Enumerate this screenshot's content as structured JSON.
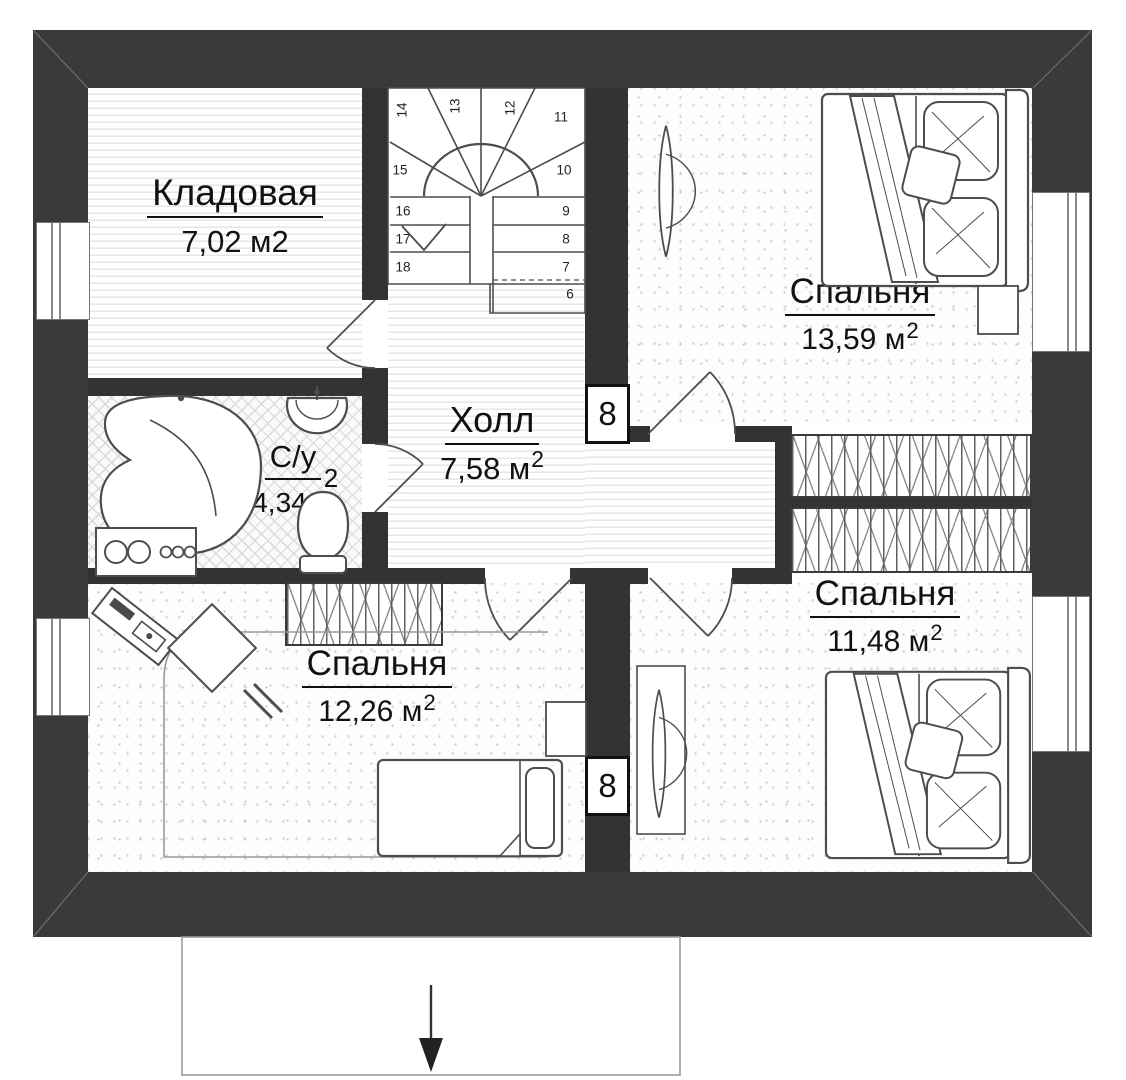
{
  "plan": {
    "rooms": [
      {
        "id": "storage",
        "name": "Кладовая",
        "area": "7,02 м2",
        "area_sup": ""
      },
      {
        "id": "hall",
        "name": "Холл",
        "area": "7,58 м",
        "area_sup": "2"
      },
      {
        "id": "bathroom",
        "name": "С/у",
        "area": "4,34 м",
        "area_sup": "2"
      },
      {
        "id": "bedroom-top-right",
        "name": "Спальня",
        "area": "13,59 м",
        "area_sup": "2"
      },
      {
        "id": "bedroom-bottom-right",
        "name": "Спальня",
        "area": "11,48 м",
        "area_sup": "2"
      },
      {
        "id": "bedroom-bottom-left",
        "name": "Спальня",
        "area": "12,26 м",
        "area_sup": "2"
      }
    ],
    "stairs": {
      "steps": [
        "6",
        "7",
        "8",
        "9",
        "10",
        "11",
        "12",
        "13",
        "14",
        "15",
        "16",
        "17",
        "18"
      ]
    },
    "vent_labels": {
      "top": "8",
      "bottom": "8"
    },
    "colors": {
      "outer_wall": "#3a3a3a",
      "partition": "#333333",
      "drawing_line": "#4d4d4d"
    }
  }
}
